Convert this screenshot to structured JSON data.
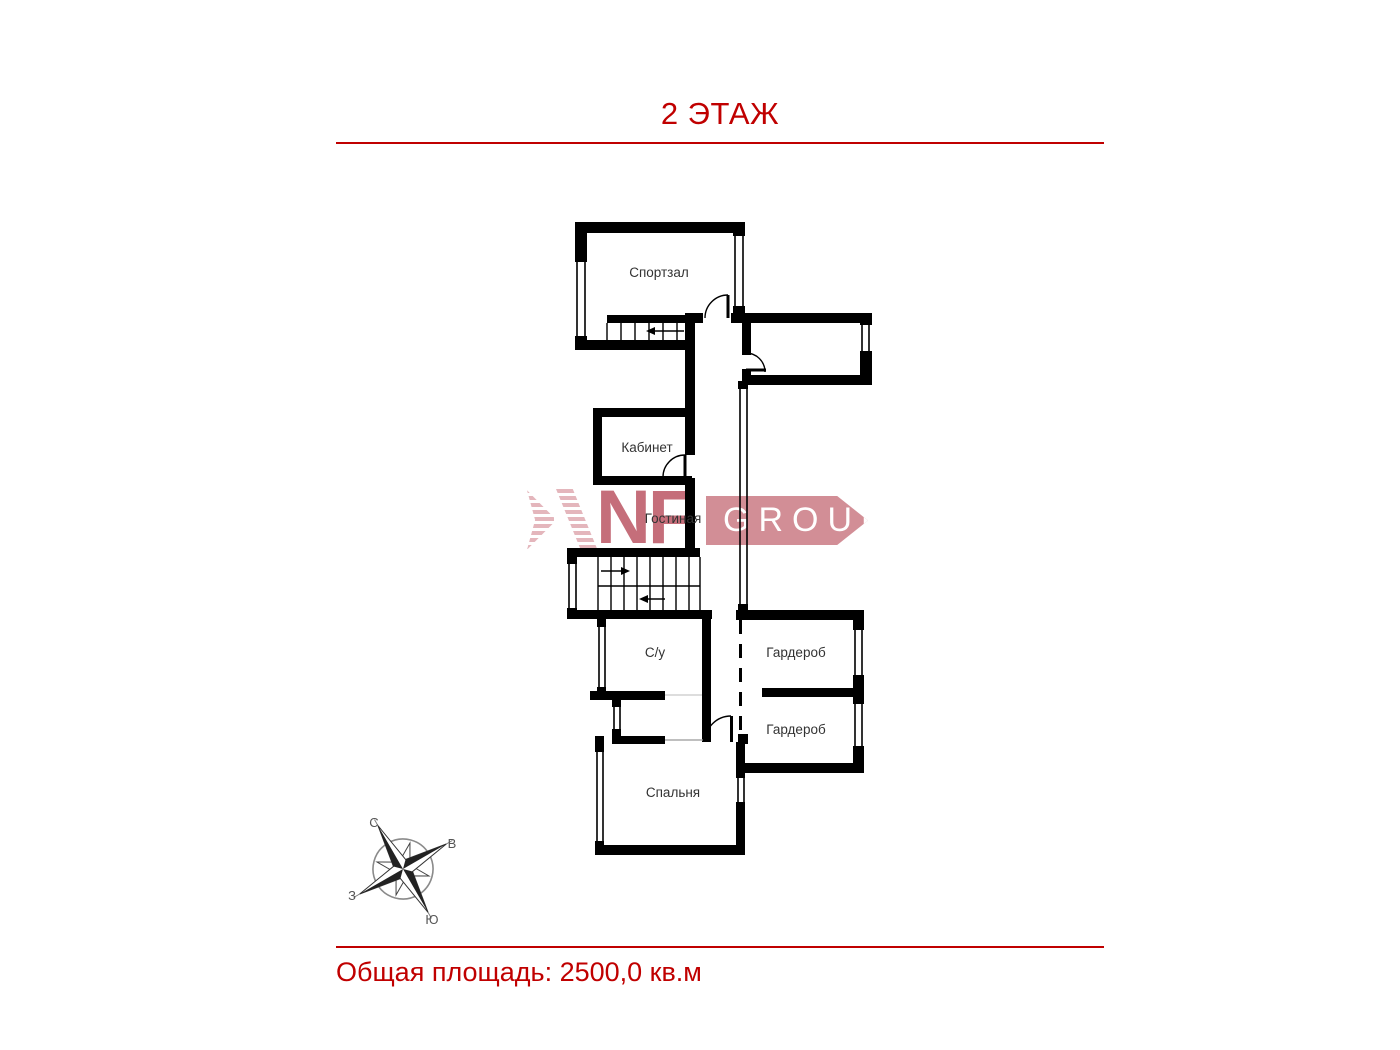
{
  "header": {
    "title": "2 ЭТАЖ",
    "accent_color": "#c00000"
  },
  "footer": {
    "total_area_label": "Общая площадь: 2500,0 кв.м"
  },
  "watermark": {
    "letters": "NF",
    "banner": "GROUP",
    "letters_color": "#b23e4e",
    "banner_color": "#c0626e",
    "stripe_color": "#c96e7a"
  },
  "plan": {
    "wall_color": "#000000",
    "rooms": [
      {
        "label": "Спортзал"
      },
      {
        "label": "Кабинет"
      },
      {
        "label": "Гостиная"
      },
      {
        "label": "С/у"
      },
      {
        "label": "Гардероб"
      },
      {
        "label": "Гардероб"
      },
      {
        "label": "Спальня"
      }
    ]
  },
  "compass": {
    "north": "С",
    "east": "В",
    "west": "З",
    "south": "Ю"
  }
}
